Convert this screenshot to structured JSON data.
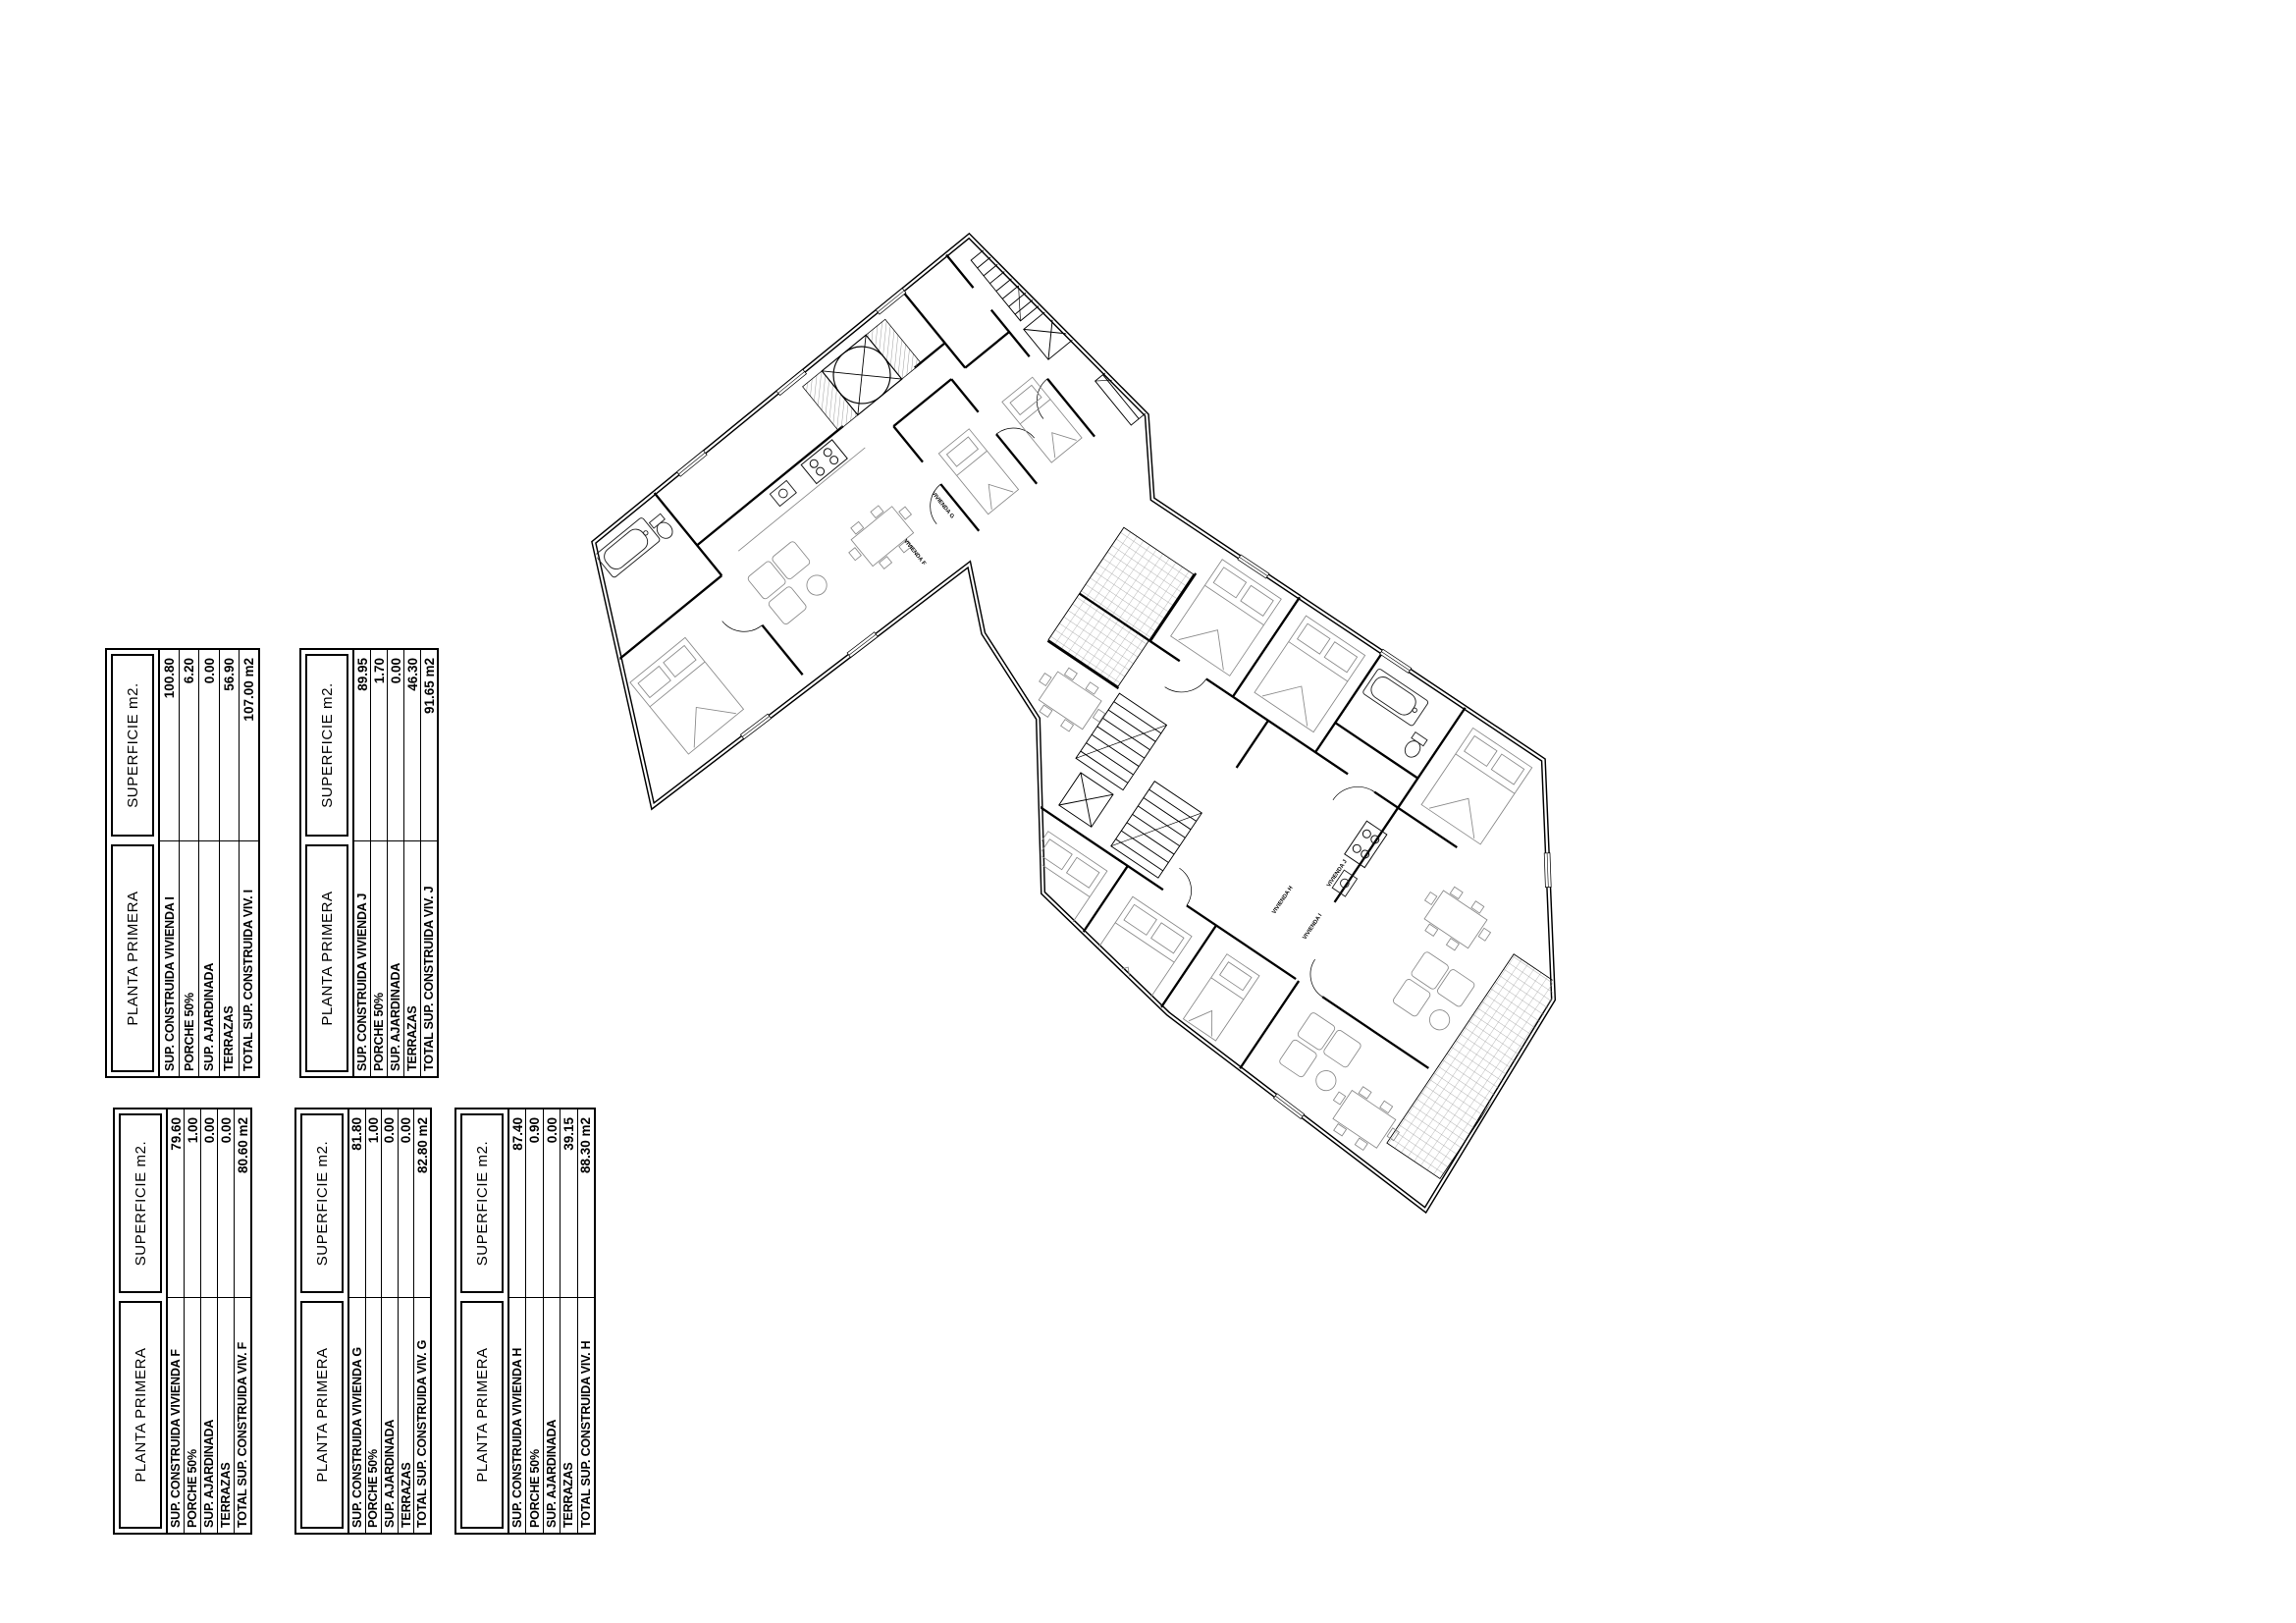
{
  "page": {
    "background": "#ffffff"
  },
  "tables": [
    {
      "id": "vivienda-i",
      "planta_header": "PLANTA PRIMERA",
      "superficie_header": "SUPERFICIE  m2.",
      "rows": [
        {
          "label": "SUP. CONSTRUIDA VIVIENDA I",
          "value": "100.80"
        },
        {
          "label": "PORCHE 50%",
          "value": "6.20"
        },
        {
          "label": "SUP. AJARDINADA",
          "value": "0.00"
        },
        {
          "label": "TERRAZAS",
          "value": "56.90"
        },
        {
          "label": "TOTAL SUP. CONSTRUIDA VIV. I",
          "value": "107.00 m2"
        }
      ]
    },
    {
      "id": "vivienda-j",
      "planta_header": "PLANTA PRIMERA",
      "superficie_header": "SUPERFICIE  m2.",
      "rows": [
        {
          "label": "SUP. CONSTRUIDA VIVIENDA J",
          "value": "89.95"
        },
        {
          "label": "PORCHE 50%",
          "value": "1.70"
        },
        {
          "label": "SUP. AJARDINADA",
          "value": "0.00"
        },
        {
          "label": "TERRAZAS",
          "value": "46.30"
        },
        {
          "label": "TOTAL SUP. CONSTRUIDA VIV. J",
          "value": "91.65 m2"
        }
      ]
    },
    {
      "id": "vivienda-f",
      "planta_header": "PLANTA PRIMERA",
      "superficie_header": "SUPERFICIE  m2.",
      "rows": [
        {
          "label": "SUP. CONSTRUIDA VIVIENDA F",
          "value": "79.60"
        },
        {
          "label": "PORCHE 50%",
          "value": "1.00"
        },
        {
          "label": "SUP. AJARDINADA",
          "value": "0.00"
        },
        {
          "label": "TERRAZAS",
          "value": "0.00"
        },
        {
          "label": "TOTAL SUP. CONSTRUIDA VIV. F",
          "value": "80.60 m2"
        }
      ]
    },
    {
      "id": "vivienda-g",
      "planta_header": "PLANTA PRIMERA",
      "superficie_header": "SUPERFICIE  m2.",
      "rows": [
        {
          "label": "SUP. CONSTRUIDA VIVIENDA G",
          "value": "81.80"
        },
        {
          "label": "PORCHE 50%",
          "value": "1.00"
        },
        {
          "label": "SUP. AJARDINADA",
          "value": "0.00"
        },
        {
          "label": "TERRAZAS",
          "value": "0.00"
        },
        {
          "label": "TOTAL SUP. CONSTRUIDA VIV. G",
          "value": "82.80 m2"
        }
      ]
    },
    {
      "id": "vivienda-h",
      "planta_header": "PLANTA PRIMERA",
      "superficie_header": "SUPERFICIE  m2.",
      "rows": [
        {
          "label": "SUP. CONSTRUIDA VIVIENDA H",
          "value": "87.40"
        },
        {
          "label": "PORCHE 50%",
          "value": "0.90"
        },
        {
          "label": "SUP. AJARDINADA",
          "value": "0.00"
        },
        {
          "label": "TERRAZAS",
          "value": "39.15"
        },
        {
          "label": "TOTAL SUP. CONSTRUIDA VIV. H",
          "value": "88.30 m2"
        }
      ]
    }
  ],
  "plan": {
    "wall_color": "#000000",
    "furniture_color": "#8a8a8a",
    "labels": [
      {
        "text": "VIVIENDA G"
      },
      {
        "text": "VIVIENDA F"
      },
      {
        "text": "VIVIENDA H"
      },
      {
        "text": "VIVIENDA I"
      },
      {
        "text": "VIVIENDA J"
      }
    ]
  }
}
